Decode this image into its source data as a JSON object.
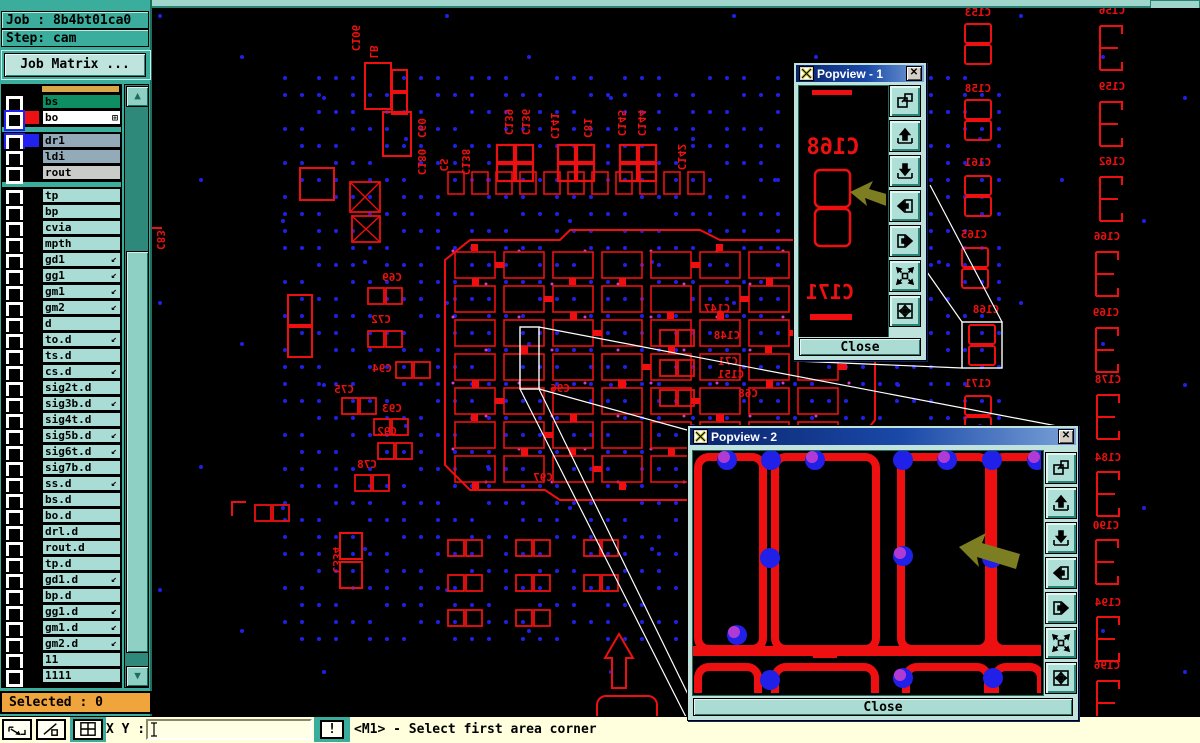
{
  "header": {
    "job_label": "Job : 8b4bt01ca0",
    "step_label": "Step: cam",
    "job_matrix_button": "Job Matrix ..."
  },
  "layers": {
    "items": [
      {
        "name": "bs",
        "bg": "#0e8f63",
        "swatch": "#000000",
        "checkbox": "plain"
      },
      {
        "name": "bo",
        "bg": "#ffffff",
        "swatch": "#ee1111",
        "checkbox": "blue",
        "grid_icon": "⊞"
      },
      {
        "gap": true
      },
      {
        "name": "dr1",
        "bg": "#93aab8",
        "swatch": "#2222ee",
        "checkbox": "blue"
      },
      {
        "name": "ldi",
        "bg": "#93aab8",
        "swatch": "#000000",
        "checkbox": "plain"
      },
      {
        "name": "rout",
        "bg": "#c9ccc9",
        "swatch": "#000000",
        "checkbox": "plain"
      },
      {
        "gap": true
      },
      {
        "name": "tp",
        "bg": "#a8dcd4",
        "swatch": "#000000",
        "checkbox": "plain"
      },
      {
        "name": "bp",
        "bg": "#a8dcd4",
        "swatch": "#000000",
        "checkbox": "plain"
      },
      {
        "name": "cvia",
        "bg": "#a8dcd4",
        "swatch": "#000000",
        "checkbox": "plain"
      },
      {
        "name": "mpth",
        "bg": "#a8dcd4",
        "swatch": "#000000",
        "checkbox": "plain"
      },
      {
        "name": "gd1",
        "bg": "#a8dcd4",
        "swatch": "#000000",
        "checkbox": "plain",
        "arrow": true
      },
      {
        "name": "gg1",
        "bg": "#a8dcd4",
        "swatch": "#000000",
        "checkbox": "plain",
        "arrow": true
      },
      {
        "name": "gm1",
        "bg": "#a8dcd4",
        "swatch": "#000000",
        "checkbox": "plain",
        "arrow": true
      },
      {
        "name": "gm2",
        "bg": "#a8dcd4",
        "swatch": "#000000",
        "checkbox": "plain",
        "arrow": true
      },
      {
        "name": "d",
        "bg": "#a8dcd4",
        "swatch": "#000000",
        "checkbox": "plain"
      },
      {
        "name": "to.d",
        "bg": "#a8dcd4",
        "swatch": "#000000",
        "checkbox": "plain",
        "arrow": true
      },
      {
        "name": "ts.d",
        "bg": "#a8dcd4",
        "swatch": "#000000",
        "checkbox": "plain"
      },
      {
        "name": "cs.d",
        "bg": "#a8dcd4",
        "swatch": "#000000",
        "checkbox": "plain",
        "arrow": true
      },
      {
        "name": "sig2t.d",
        "bg": "#a8dcd4",
        "swatch": "#000000",
        "checkbox": "plain"
      },
      {
        "name": "sig3b.d",
        "bg": "#a8dcd4",
        "swatch": "#000000",
        "checkbox": "plain",
        "arrow": true
      },
      {
        "name": "sig4t.d",
        "bg": "#a8dcd4",
        "swatch": "#000000",
        "checkbox": "plain"
      },
      {
        "name": "sig5b.d",
        "bg": "#a8dcd4",
        "swatch": "#000000",
        "checkbox": "plain",
        "arrow": true
      },
      {
        "name": "sig6t.d",
        "bg": "#a8dcd4",
        "swatch": "#000000",
        "checkbox": "plain",
        "arrow": true
      },
      {
        "name": "sig7b.d",
        "bg": "#a8dcd4",
        "swatch": "#000000",
        "checkbox": "plain"
      },
      {
        "name": "ss.d",
        "bg": "#a8dcd4",
        "swatch": "#000000",
        "checkbox": "plain",
        "arrow": true
      },
      {
        "name": "bs.d",
        "bg": "#a8dcd4",
        "swatch": "#000000",
        "checkbox": "plain"
      },
      {
        "name": "bo.d",
        "bg": "#a8dcd4",
        "swatch": "#000000",
        "checkbox": "plain"
      },
      {
        "name": "drl.d",
        "bg": "#a8dcd4",
        "swatch": "#000000",
        "checkbox": "plain"
      },
      {
        "name": "rout.d",
        "bg": "#a8dcd4",
        "swatch": "#000000",
        "checkbox": "plain"
      },
      {
        "name": "tp.d",
        "bg": "#a8dcd4",
        "swatch": "#000000",
        "checkbox": "plain"
      },
      {
        "name": "gd1.d",
        "bg": "#a8dcd4",
        "swatch": "#000000",
        "checkbox": "plain",
        "arrow": true
      },
      {
        "name": "bp.d",
        "bg": "#a8dcd4",
        "swatch": "#000000",
        "checkbox": "plain"
      },
      {
        "name": "gg1.d",
        "bg": "#a8dcd4",
        "swatch": "#000000",
        "checkbox": "plain",
        "arrow": true
      },
      {
        "name": "gm1.d",
        "bg": "#a8dcd4",
        "swatch": "#000000",
        "checkbox": "plain",
        "arrow": true
      },
      {
        "name": "gm2.d",
        "bg": "#a8dcd4",
        "swatch": "#000000",
        "checkbox": "plain",
        "arrow": true
      },
      {
        "name": "11",
        "bg": "#a8dcd4",
        "swatch": "#000000",
        "checkbox": "plain"
      },
      {
        "name": "1111",
        "bg": "#a8dcd4",
        "swatch": "#000000",
        "checkbox": "plain"
      }
    ]
  },
  "selected_label": "Selected : 0",
  "statusbar": {
    "xy_label": "X Y :",
    "input_value": "",
    "alert_button": "!",
    "message": "<M1> - Select first area corner"
  },
  "popview1": {
    "title": "Popview - 1",
    "close_label": "Close",
    "content_labels": [
      "C168",
      "C171"
    ],
    "toolbar_icons": [
      "copy-window-icon",
      "pan-up-icon",
      "pan-down-icon",
      "pan-left-icon",
      "pan-right-icon",
      "fit-view-icon",
      "center-view-icon"
    ]
  },
  "popview2": {
    "title": "Popview - 2",
    "close_label": "Close",
    "toolbar_icons": [
      "copy-window-icon",
      "pan-up-icon",
      "pan-down-icon",
      "pan-left-icon",
      "pan-right-icon",
      "fit-view-icon",
      "center-view-icon"
    ]
  },
  "colors": {
    "trace_red": "#ee1010",
    "via_blue": "#2020e8",
    "via_magenta": "#cc40d0",
    "callout_white": "#ffffff",
    "cursor_olive": "#7d7d21",
    "panel_teal": "#3bad9c",
    "selected_orange": "#f0a43c"
  },
  "canvas": {
    "labels": [
      {
        "t": "C153",
        "x": 978,
        "y": 16
      },
      {
        "t": "C158",
        "x": 978,
        "y": 92
      },
      {
        "t": "C161",
        "x": 978,
        "y": 166
      },
      {
        "t": "C165",
        "x": 974,
        "y": 238
      },
      {
        "t": "C168",
        "x": 986,
        "y": 313
      },
      {
        "t": "C171",
        "x": 978,
        "y": 387
      },
      {
        "t": "C156",
        "x": 1112,
        "y": 14
      },
      {
        "t": "C159",
        "x": 1112,
        "y": 90
      },
      {
        "t": "C162",
        "x": 1112,
        "y": 165
      },
      {
        "t": "C166",
        "x": 1107,
        "y": 240
      },
      {
        "t": "C169",
        "x": 1106,
        "y": 316
      },
      {
        "t": "C178",
        "x": 1108,
        "y": 383
      },
      {
        "t": "C184",
        "x": 1108,
        "y": 461
      },
      {
        "t": "C190",
        "x": 1106,
        "y": 529
      },
      {
        "t": "C194",
        "x": 1108,
        "y": 606
      },
      {
        "t": "C196",
        "x": 1107,
        "y": 669
      },
      {
        "t": "C69",
        "x": 392,
        "y": 281
      },
      {
        "t": "C72",
        "x": 381,
        "y": 323
      },
      {
        "t": "C94",
        "x": 382,
        "y": 372
      },
      {
        "t": "C75",
        "x": 344,
        "y": 393
      },
      {
        "t": "C93",
        "x": 392,
        "y": 412
      },
      {
        "t": "C92",
        "x": 387,
        "y": 435
      },
      {
        "t": "C78",
        "x": 367,
        "y": 468
      },
      {
        "t": "C96",
        "x": 560,
        "y": 392
      },
      {
        "t": "C97",
        "x": 543,
        "y": 481
      },
      {
        "t": "C147",
        "x": 717,
        "y": 312
      },
      {
        "t": "C148",
        "x": 727,
        "y": 339
      },
      {
        "t": "C71",
        "x": 728,
        "y": 365
      },
      {
        "t": "C151",
        "x": 731,
        "y": 378
      },
      {
        "t": "C68",
        "x": 748,
        "y": 397
      },
      {
        "t": "C106",
        "x": 352,
        "y": 38,
        "rot": 90
      },
      {
        "t": "LB",
        "x": 370,
        "y": 52,
        "rot": 90
      },
      {
        "t": "C60",
        "x": 418,
        "y": 128,
        "rot": 90
      },
      {
        "t": "C180",
        "x": 418,
        "y": 162,
        "rot": 90
      },
      {
        "t": "CS",
        "x": 440,
        "y": 165,
        "rot": 90
      },
      {
        "t": "C138",
        "x": 462,
        "y": 162,
        "rot": 90
      },
      {
        "t": "C139",
        "x": 505,
        "y": 122,
        "rot": 90
      },
      {
        "t": "C136",
        "x": 522,
        "y": 122,
        "rot": 90
      },
      {
        "t": "C141",
        "x": 551,
        "y": 126,
        "rot": 90
      },
      {
        "t": "C81",
        "x": 584,
        "y": 128,
        "rot": 90
      },
      {
        "t": "C145",
        "x": 618,
        "y": 123,
        "rot": 90
      },
      {
        "t": "C144",
        "x": 638,
        "y": 123,
        "rot": 90
      },
      {
        "t": "C142",
        "x": 678,
        "y": 157,
        "rot": 90
      },
      {
        "t": "C334",
        "x": 333,
        "y": 560,
        "rot": 90
      },
      {
        "t": "C83",
        "x": 157,
        "y": 240,
        "rot": 90
      }
    ],
    "cap2v_footprints": [
      {
        "x": 965,
        "y": 24
      },
      {
        "x": 965,
        "y": 100
      },
      {
        "x": 965,
        "y": 176
      },
      {
        "x": 962,
        "y": 248
      },
      {
        "x": 969,
        "y": 325
      },
      {
        "x": 965,
        "y": 396
      }
    ],
    "cap3_footprints": [
      {
        "x": 1100,
        "y": 26
      },
      {
        "x": 1100,
        "y": 102
      },
      {
        "x": 1100,
        "y": 177
      },
      {
        "x": 1096,
        "y": 252
      },
      {
        "x": 1096,
        "y": 328
      },
      {
        "x": 1097,
        "y": 395
      },
      {
        "x": 1097,
        "y": 472
      },
      {
        "x": 1096,
        "y": 540
      },
      {
        "x": 1097,
        "y": 617
      },
      {
        "x": 1097,
        "y": 681
      }
    ],
    "cap2h_footprints": [
      {
        "x": 368,
        "y": 288
      },
      {
        "x": 368,
        "y": 331
      },
      {
        "x": 396,
        "y": 362
      },
      {
        "x": 342,
        "y": 398
      },
      {
        "x": 374,
        "y": 419
      },
      {
        "x": 378,
        "y": 443
      },
      {
        "x": 355,
        "y": 475
      },
      {
        "x": 660,
        "y": 330
      },
      {
        "x": 660,
        "y": 360
      },
      {
        "x": 660,
        "y": 390
      },
      {
        "x": 448,
        "y": 540
      },
      {
        "x": 448,
        "y": 575
      },
      {
        "x": 448,
        "y": 610
      },
      {
        "x": 516,
        "y": 540
      },
      {
        "x": 516,
        "y": 575
      },
      {
        "x": 516,
        "y": 610
      },
      {
        "x": 584,
        "y": 540
      },
      {
        "x": 584,
        "y": 575
      },
      {
        "x": 255,
        "y": 505
      }
    ],
    "grid2x2_footprints": [
      {
        "x": 497,
        "y": 145
      },
      {
        "x": 558,
        "y": 145
      },
      {
        "x": 620,
        "y": 145
      }
    ],
    "big_rects": [
      [
        365,
        63,
        26,
        46
      ],
      [
        392,
        70,
        15,
        21
      ],
      [
        392,
        93,
        15,
        21
      ],
      [
        383,
        112,
        28,
        44
      ],
      [
        300,
        168,
        34,
        32
      ],
      [
        288,
        295,
        24,
        30
      ],
      [
        288,
        327,
        24,
        30
      ],
      [
        340,
        533,
        22,
        26
      ],
      [
        340,
        562,
        22,
        26
      ]
    ],
    "cross_rects": [
      [
        350,
        182,
        30,
        30
      ],
      [
        352,
        216,
        28,
        26
      ]
    ],
    "small_rect_row": {
      "x0": 448,
      "y": 172,
      "w": 16,
      "h": 22,
      "step": 24,
      "count": 11
    },
    "zoom_rects": [
      {
        "x": 520,
        "y": 327,
        "w": 19,
        "h": 62
      },
      {
        "x": 962,
        "y": 322,
        "w": 40,
        "h": 46
      }
    ],
    "callout_lines": [
      [
        539,
        327,
        1078,
        430
      ],
      [
        539,
        389,
        687,
        430
      ],
      [
        520,
        389,
        687,
        719
      ],
      [
        539,
        389,
        700,
        719
      ],
      [
        962,
        322,
        927,
        272
      ],
      [
        962,
        368,
        795,
        361
      ],
      [
        1002,
        322,
        930,
        185
      ]
    ],
    "up_arrow": {
      "x": 605,
      "y": 632
    },
    "round_rect": [
      597,
      696,
      60,
      44
    ],
    "brackets": [
      "M232,516 v-14 h14",
      "M150,252 v-24 h12"
    ],
    "cluster": {
      "x0": 455,
      "y0": 252,
      "cols": 8,
      "rows": 7,
      "cw": 49,
      "rh": 34,
      "outline": "M445,300 L445,260 L470,240 L560,240 L570,230 L700,230 L720,240 L840,240 L860,260 L860,300 L875,315 L875,420 L855,445 L855,470 L830,490 L700,490 L690,500 L560,500 L545,490 L470,490 L445,465 Z"
    },
    "pv2_scene": {
      "top_cells": [
        [
          5,
          6,
          65,
          192
        ],
        [
          82,
          6,
          101,
          192
        ],
        [
          208,
          6,
          88,
          192
        ],
        [
          300,
          6,
          58,
          192
        ]
      ],
      "bottom_cells": [
        [
          5,
          216,
          60,
          60
        ],
        [
          82,
          216,
          100,
          60
        ],
        [
          213,
          216,
          82,
          60
        ],
        [
          302,
          216,
          46,
          60
        ]
      ],
      "trunk_y": 200,
      "bulge": [
        120,
        194,
        24,
        13
      ],
      "dots": [
        [
          34,
          9
        ],
        [
          78,
          9
        ],
        [
          122,
          9
        ],
        [
          210,
          9
        ],
        [
          254,
          9
        ],
        [
          299,
          9
        ],
        [
          344,
          9
        ],
        [
          77,
          107
        ],
        [
          210,
          105
        ],
        [
          299,
          107
        ],
        [
          44,
          184
        ],
        [
          77,
          229
        ],
        [
          210,
          227
        ],
        [
          300,
          227
        ]
      ]
    }
  }
}
